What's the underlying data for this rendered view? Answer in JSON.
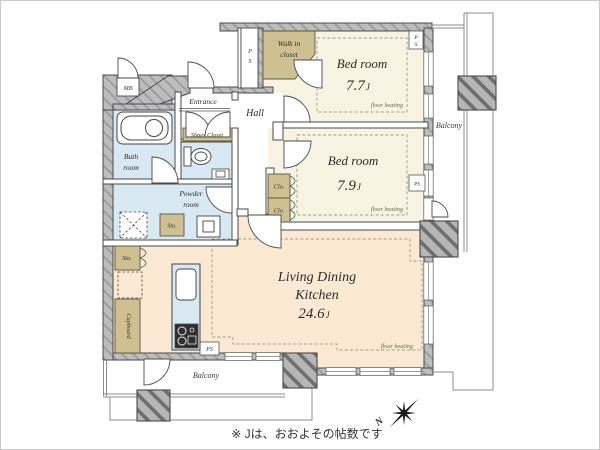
{
  "rooms": {
    "bedroom1": {
      "name": "Bed room",
      "size": "7.7",
      "unit": "J"
    },
    "bedroom2": {
      "name": "Bed room",
      "size": "7.9",
      "unit": "J"
    },
    "ldk": {
      "line1": "Living Dining",
      "line2": "Kitchen",
      "size": "24.6",
      "unit": "J"
    },
    "hall": {
      "name": "Hall"
    },
    "entrance": {
      "name": "Entrance"
    },
    "bath": {
      "line1": "Bath",
      "line2": "room"
    },
    "powder": {
      "line1": "Powder",
      "line2": "room"
    },
    "walk_in_closet": {
      "line1": "Walk in",
      "line2": "closet"
    },
    "shoes_closet": {
      "name": "Shoes Closet"
    },
    "cupboard": {
      "name": "Cupboard"
    }
  },
  "labels": {
    "floor_heating": "floor heating",
    "balcony": "Balcony",
    "mb": "MB",
    "ps_p": "P",
    "ps_s": "S",
    "ps": "PS",
    "clo": "Clo.",
    "sto": "Sto.",
    "compass_north": "N"
  },
  "footnote": "※ Jは、おおよその帖数です",
  "colors": {
    "bedroom_floor": "#f8f4e3",
    "ldk_floor": "#fbe9d3",
    "wet_area_floor": "#d9e9f4",
    "closet_fill": "#cfc092",
    "wall_gray": "#bdbdbd",
    "heating_dash": "#a09a80",
    "railing_gray": "#8c8c8c"
  }
}
